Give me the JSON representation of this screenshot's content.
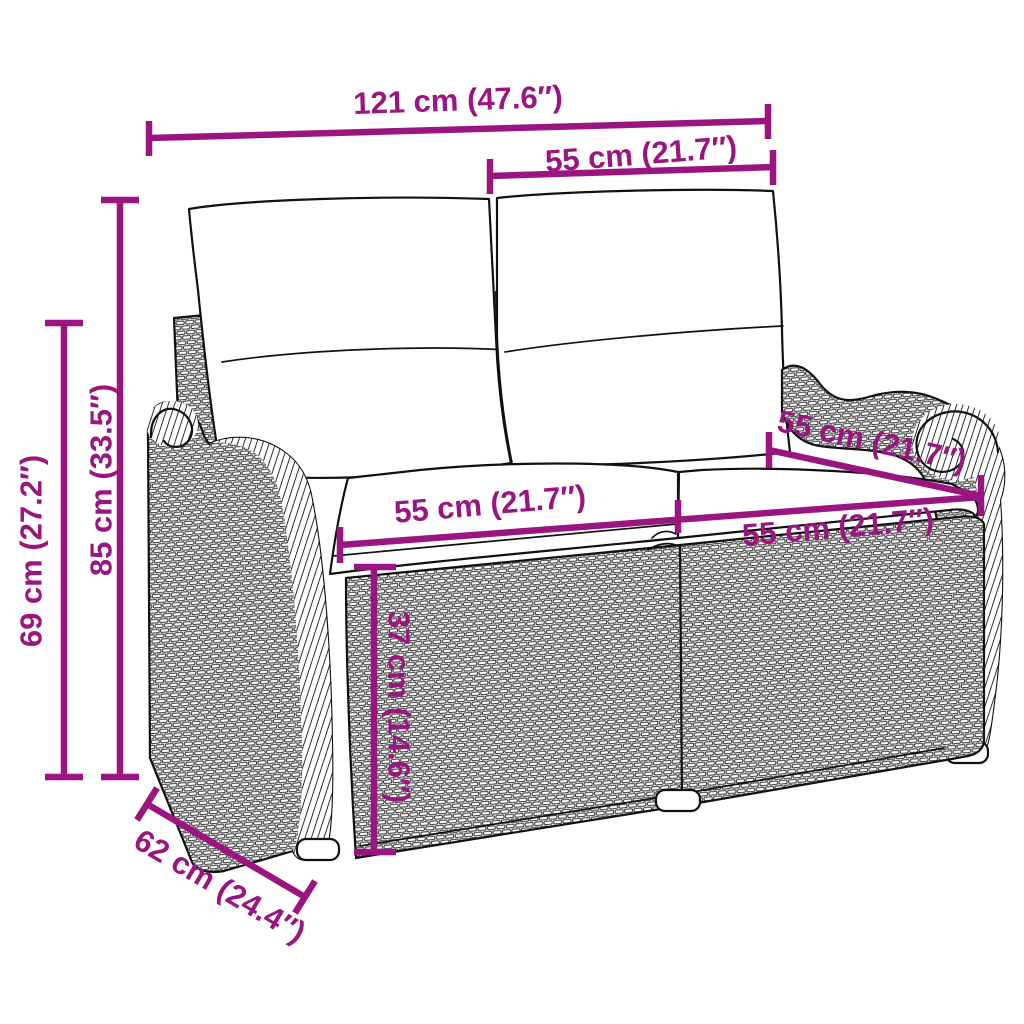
{
  "diagram": {
    "subject": "poly-rattan-2-seater-garden-bench-with-cushions",
    "accent_color": "#9A1580",
    "outline_color": "#111111",
    "background_color": "#ffffff"
  },
  "dims": {
    "overall_width": {
      "label": "121 cm (47.6″)"
    },
    "back_cushion_width": {
      "label": "55 cm (21.7″)"
    },
    "overall_height": {
      "label": "85 cm (33.5″)"
    },
    "backrest_height": {
      "label": "69 cm (27.2″)"
    },
    "seat_width_left": {
      "label": "55 cm (21.7″)"
    },
    "seat_width_right": {
      "label": "55 cm (21.7″)"
    },
    "seat_depth": {
      "label": "55 cm (21.7″)"
    },
    "seat_height": {
      "label": "37 cm (14.6″)"
    },
    "base_depth": {
      "label": "62 cm (24.4″)"
    }
  }
}
